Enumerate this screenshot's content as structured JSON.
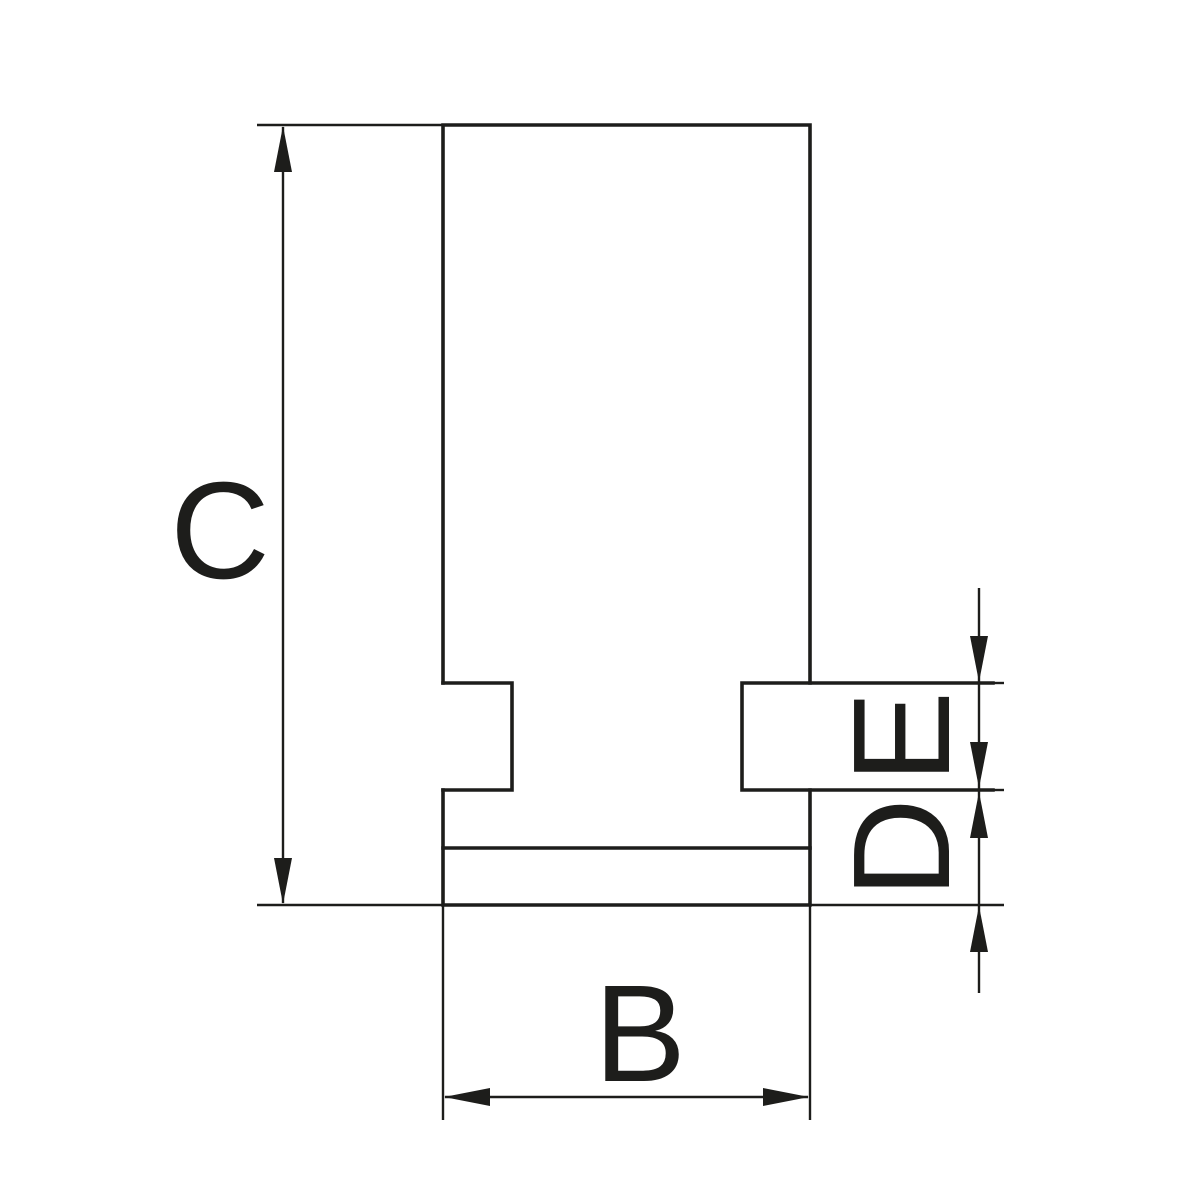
{
  "drawing": {
    "background_color": "#ffffff",
    "line_color": "#1d1d1b",
    "labels": {
      "c": "C",
      "b": "B",
      "e": "E",
      "d": "D"
    }
  }
}
